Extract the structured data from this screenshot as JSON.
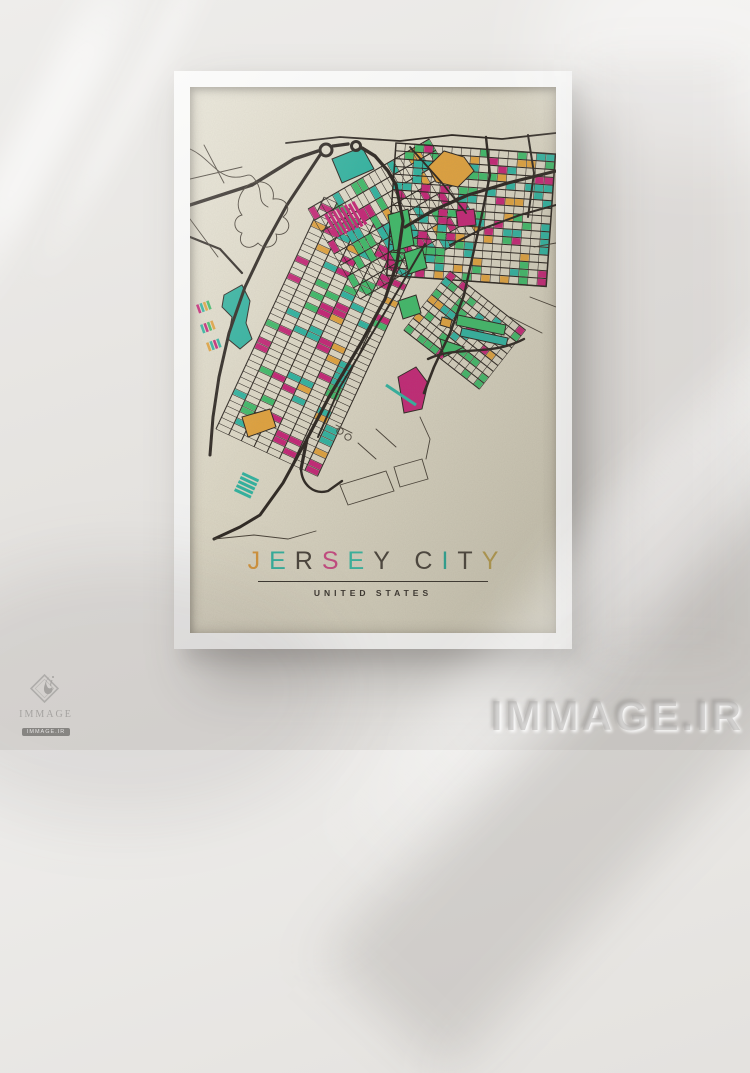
{
  "poster": {
    "title": "JERSEY CITY",
    "title_letters": [
      {
        "ch": "J",
        "color": "#cf923c"
      },
      {
        "ch": "E",
        "color": "#35ad9b"
      },
      {
        "ch": "R",
        "color": "#4a443c"
      },
      {
        "ch": "S",
        "color": "#c34a80"
      },
      {
        "ch": "E",
        "color": "#38b29d"
      },
      {
        "ch": "Y",
        "color": "#4a443c"
      },
      {
        "ch": " ",
        "color": null
      },
      {
        "ch": "C",
        "color": "#4a443c"
      },
      {
        "ch": "I",
        "color": "#2da291"
      },
      {
        "ch": "T",
        "color": "#4a443c"
      },
      {
        "ch": "Y",
        "color": "#b0974d"
      }
    ],
    "subtitle": "UNITED STATES",
    "colors": {
      "poster_background": "#dcd7c5",
      "frame": "#f4f4f3",
      "wall": "#e7e5e2",
      "text": "#3b362f"
    }
  },
  "watermarks": {
    "large_text": "IMMAGE.IR",
    "logo_text": "IMMAGE",
    "logo_badge": "IMMAGE.IR"
  },
  "map": {
    "palette": {
      "street": "#2b2520",
      "thin": "#453e34",
      "teal": "#2fb3a0",
      "green": "#3fba69",
      "magenta": "#c42576",
      "orange": "#e0a23e"
    },
    "color_weights": [
      [
        "magenta",
        0.28
      ],
      [
        "teal",
        0.27
      ],
      [
        "green",
        0.27
      ],
      [
        "orange",
        0.18
      ]
    ],
    "patches": [
      {
        "x": 26,
        "y": 342,
        "rot": -65,
        "cols": 40,
        "cw": 6.4,
        "rows": 8,
        "ch": 14,
        "seed": 11,
        "colorRate": 0.3,
        "border": false
      },
      {
        "x": 118,
        "y": 122,
        "rot": -30,
        "cols": 20,
        "cw": 7,
        "rows": 8,
        "ch": 13,
        "seed": 23,
        "colorRate": 0.3,
        "border": false
      },
      {
        "x": 206,
        "y": 56,
        "rot": 4,
        "cols": 17,
        "cw": 9.4,
        "rows": 17,
        "ch": 7.8,
        "seed": 37,
        "colorRate": 0.32,
        "border": true
      },
      {
        "x": 260,
        "y": 184,
        "rot": 38,
        "cols": 12,
        "cw": 8,
        "rows": 10,
        "ch": 7.5,
        "seed": 51,
        "colorRate": 0.26,
        "border": false
      }
    ]
  }
}
